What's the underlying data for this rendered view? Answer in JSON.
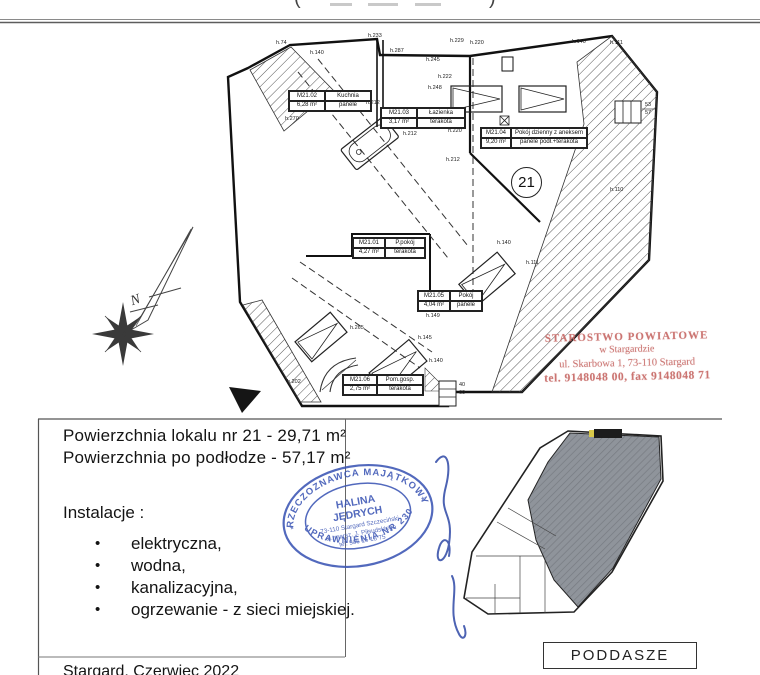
{
  "colors": {
    "stamp_red": "#c66864",
    "stamp_blue": "#3b55b4",
    "miniplan_fill": "#8f949b",
    "line": "#111111"
  },
  "top": {
    "left_paren": "(",
    "right_paren": ")"
  },
  "plan": {
    "unit_circle_label": "21",
    "north_label": "N",
    "rooms": [
      {
        "id": "M21.01",
        "name": "P.pokój",
        "area": "4,27 m²",
        "floor": "terakota"
      },
      {
        "id": "M21.02",
        "name": "Kuchnia",
        "area": "6,28 m²",
        "floor": "panele"
      },
      {
        "id": "M21.03",
        "name": "Łazienka",
        "area": "3,17 m²",
        "floor": "terakota"
      },
      {
        "id": "M21.04",
        "name": "Pokój dzienny z aneksem",
        "area": "9,20 m²",
        "floor": "panele podł.+terakota"
      },
      {
        "id": "M21.05",
        "name": "Pokój",
        "area": "4,04 m²",
        "floor": "panele"
      },
      {
        "id": "M21.06",
        "name": "Pom.gosp.",
        "area": "2,75 m²",
        "floor": "terakota"
      }
    ],
    "dimensions": [
      "h.74",
      "h.233",
      "h.287",
      "h.140",
      "h.245",
      "h.222",
      "h.248",
      "h.229",
      "h.220",
      "h.140",
      "h.111",
      "h.270",
      "h.212",
      "h.212",
      "h.220",
      "h.140",
      "h.111",
      "h.265",
      "h.149",
      "h.145",
      "h.140",
      "h.202",
      "h.110",
      "h.212"
    ],
    "window_sizes": [
      "53",
      "57",
      "40",
      "60"
    ]
  },
  "stamps": {
    "red": {
      "line1": "STAROSTWO POWIATOWE",
      "line2": "w Stargardzie",
      "line3": "ul. Skarbowa 1, 73-110 Stargard",
      "line4": "tel. 9148048 00, fax 9148048 71"
    },
    "blue": {
      "arc_top": "RZECZOZNAWCA MAJĄTKOWY",
      "arc_bottom": "UPRAWNIENIA NR 230",
      "name1": "HALINA",
      "name2": "JĘDRYCH",
      "addr1": "73-110 Stargard Szczeciński",
      "addr2": "ul. marsz. J. Piłsudskiego",
      "addr3": "tel. 506 15 18 75",
      "ornament": "*"
    }
  },
  "details": {
    "area_line1": "Powierzchnia lokalu nr 21 - 29,71 m²",
    "area_line2": "Powierzchnia po podłodze - 57,17 m²",
    "installations_title": "Instalacje :",
    "bullet": "•",
    "installations": [
      "elektryczna,",
      "wodna,",
      "kanalizacyjna,",
      "ogrzewanie - z sieci miejskiej."
    ],
    "footer_partial": "Stargard, Czerwiec 2022"
  },
  "miniplan": {
    "label": "PODDASZE"
  }
}
